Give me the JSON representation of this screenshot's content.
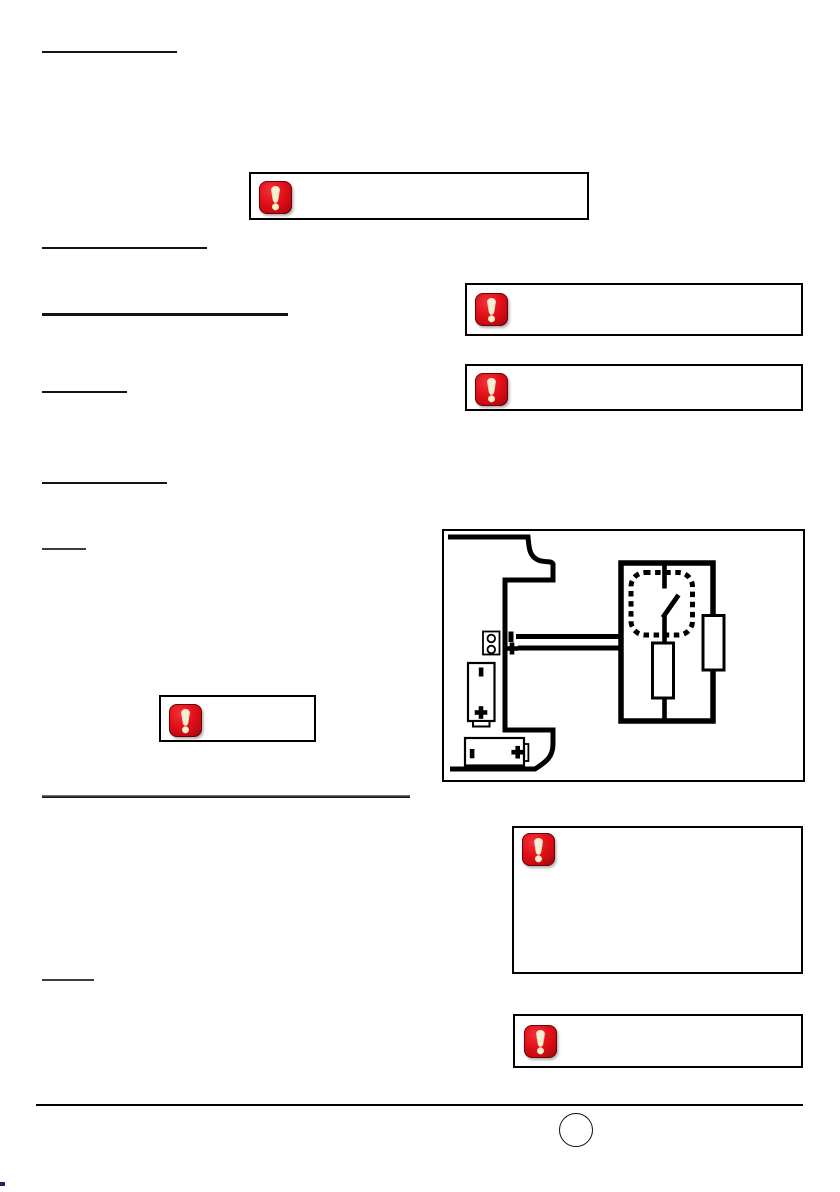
{
  "page": {
    "background": "#ffffff",
    "kind": "manual-page-with-redacted-text"
  },
  "colors": {
    "rule_black": "#141414",
    "rule_gray": "#3d3d3d",
    "box_border": "#000000",
    "warning_red_bright": "#e31018",
    "warning_red_dark": "#6f0106",
    "exclamation_cream": "#f6eed2",
    "diagram_ink": "#000000"
  },
  "icons": {
    "warning": "warning-exclamation-icon"
  },
  "headings": {
    "count": 8,
    "text": ""
  },
  "warning_boxes": {
    "count": 6,
    "content": ""
  },
  "figure": {
    "type": "circuit-diagram",
    "elements": [
      "chassis-outline",
      "terminal-block",
      "minus-polarity-mark",
      "plus-polarity-mark",
      "wire-pair",
      "circuit-loop",
      "relay-dotted-outline",
      "switch-blade",
      "resistor-middle",
      "resistor-right",
      "battery-vertical",
      "battery-horizontal"
    ]
  },
  "footer": {
    "page_number": ""
  }
}
